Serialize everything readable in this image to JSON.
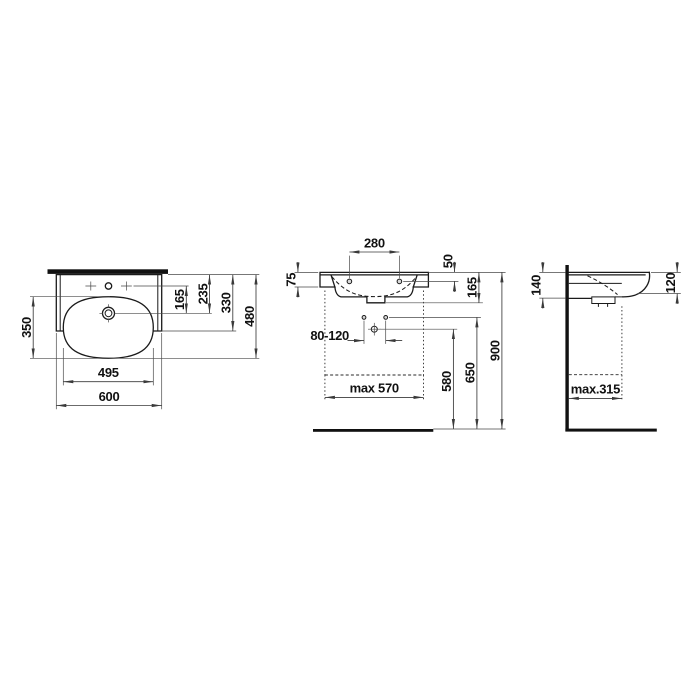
{
  "colors": {
    "background": "#ffffff",
    "line": "#1a1a1a",
    "dimension_line": "#3a3a3a",
    "text": "#111111"
  },
  "views": {
    "top": {
      "dims": {
        "bowl_depth": "350",
        "tap_to_drain": "165",
        "rear_edge_to_drain": "235",
        "body_depth": "330",
        "total_depth": "480",
        "bowl_width": "495",
        "total_width": "600"
      }
    },
    "front": {
      "dims": {
        "tap_hole_spacing": "280",
        "rim_to_fixing_holes": "50",
        "side_flange_height": "75",
        "apron_height": "165",
        "bracket_spacing": "80-120",
        "max_clearance_width": "max 570",
        "trap_height": "580",
        "fixing_height": "650",
        "rim_height": "900"
      }
    },
    "side": {
      "dims": {
        "depth_at_wall": "140",
        "front_edge_height": "120",
        "max_clearance_depth": "max.315"
      }
    }
  }
}
